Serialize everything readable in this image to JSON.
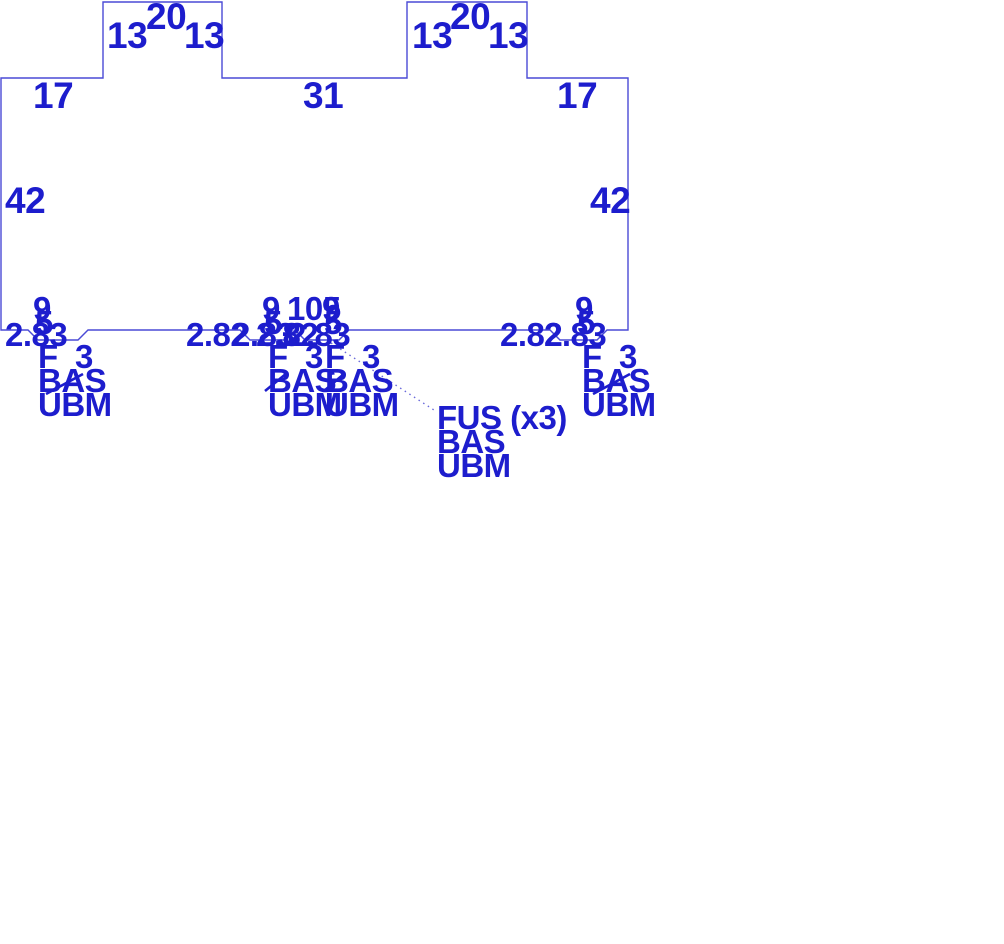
{
  "drawing": {
    "colors": {
      "background": "#ffffff",
      "line": "#4a4ad6",
      "text": "#1d1dcd",
      "leader": "#6a6ada"
    },
    "panel_outline": {
      "description": "precast panel elevation with two top tabs and four bottom chamfered notches",
      "points": [
        [
          1,
          78
        ],
        [
          103,
          78
        ],
        [
          103,
          2
        ],
        [
          222,
          2
        ],
        [
          222,
          78
        ],
        [
          407,
          78
        ],
        [
          407,
          2
        ],
        [
          527,
          2
        ],
        [
          527,
          78
        ],
        [
          628,
          78
        ],
        [
          628,
          330
        ],
        [
          607,
          330
        ],
        [
          597,
          340
        ],
        [
          560,
          340
        ],
        [
          550,
          330
        ],
        [
          349,
          330
        ],
        [
          339,
          340
        ],
        [
          305,
          340
        ],
        [
          295,
          330
        ],
        [
          285,
          340
        ],
        [
          250,
          340
        ],
        [
          240,
          330
        ],
        [
          88,
          330
        ],
        [
          78,
          340
        ],
        [
          38,
          340
        ],
        [
          28,
          330
        ],
        [
          1,
          330
        ]
      ],
      "segment_dimensions": {
        "top_tab_sides": 13,
        "top_tab_width": 20,
        "top_edge_outer": 17,
        "top_edge_middle": 31,
        "side_height": 42,
        "notch_opening": 9,
        "notch_bottom": 5,
        "notch_chamfers": [
          2.82,
          2.83
        ],
        "notch_spacing": 105
      }
    },
    "dimension_labels": [
      {
        "text": "13",
        "x": 107,
        "y": 17,
        "size": "large"
      },
      {
        "text": "20",
        "x": 146,
        "y": -2,
        "size": "large"
      },
      {
        "text": "13",
        "x": 184,
        "y": 17,
        "size": "large"
      },
      {
        "text": "13",
        "x": 412,
        "y": 17,
        "size": "large"
      },
      {
        "text": "20",
        "x": 450,
        "y": -2,
        "size": "large"
      },
      {
        "text": "13",
        "x": 488,
        "y": 17,
        "size": "large"
      },
      {
        "text": "17",
        "x": 33,
        "y": 77,
        "size": "large"
      },
      {
        "text": "31",
        "x": 303,
        "y": 77,
        "size": "large"
      },
      {
        "text": "17",
        "x": 557,
        "y": 77,
        "size": "large"
      },
      {
        "text": "42",
        "x": 5,
        "y": 182,
        "size": "large"
      },
      {
        "text": "42",
        "x": 590,
        "y": 182,
        "size": "large"
      },
      {
        "text": "9",
        "x": 33,
        "y": 292,
        "size": "small"
      },
      {
        "text": "5",
        "x": 35,
        "y": 306,
        "size": "small"
      },
      {
        "text": "2.83",
        "x": 5,
        "y": 318,
        "size": "small"
      },
      {
        "text": "9",
        "x": 262,
        "y": 292,
        "size": "small"
      },
      {
        "text": "105",
        "x": 287,
        "y": 292,
        "size": "small"
      },
      {
        "text": "9",
        "x": 322,
        "y": 292,
        "size": "small"
      },
      {
        "text": "5",
        "x": 264,
        "y": 306,
        "size": "small"
      },
      {
        "text": "5",
        "x": 324,
        "y": 306,
        "size": "small"
      },
      {
        "text": "2.82",
        "x": 186,
        "y": 318,
        "size": "small"
      },
      {
        "text": "2.83",
        "x": 232,
        "y": 318,
        "size": "small"
      },
      {
        "text": "2.82",
        "x": 256,
        "y": 318,
        "size": "small"
      },
      {
        "text": "2.83",
        "x": 288,
        "y": 318,
        "size": "small"
      },
      {
        "text": "9",
        "x": 575,
        "y": 292,
        "size": "small"
      },
      {
        "text": "5",
        "x": 577,
        "y": 306,
        "size": "small"
      },
      {
        "text": "2.82",
        "x": 500,
        "y": 318,
        "size": "small"
      },
      {
        "text": "2.83",
        "x": 544,
        "y": 318,
        "size": "small"
      }
    ],
    "insert_blocks": [
      {
        "lines": [
          "F  3",
          "BAS",
          "UBM"
        ],
        "x": 38,
        "y": 345
      },
      {
        "lines": [
          "F  3",
          "BAS",
          "UBM"
        ],
        "x": 268,
        "y": 345
      },
      {
        "lines": [
          "F  3",
          "BAS",
          "UBM"
        ],
        "x": 325,
        "y": 345
      },
      {
        "lines": [
          "F  3",
          "BAS",
          "UBM"
        ],
        "x": 582,
        "y": 345
      }
    ],
    "insert_tick_marks": [
      {
        "x1": 46,
        "y1": 394,
        "x2": 83,
        "y2": 374
      },
      {
        "x1": 265,
        "y1": 391,
        "x2": 287,
        "y2": 373
      },
      {
        "x1": 324,
        "y1": 391,
        "x2": 345,
        "y2": 373
      },
      {
        "x1": 593,
        "y1": 394,
        "x2": 630,
        "y2": 374
      }
    ],
    "callout": {
      "lines": [
        "FUS (x3)",
        "BAS",
        "UBM"
      ],
      "x": 437,
      "y": 406,
      "leader": {
        "x1": 331,
        "y1": 343,
        "x2": 437,
        "y2": 412
      }
    }
  }
}
